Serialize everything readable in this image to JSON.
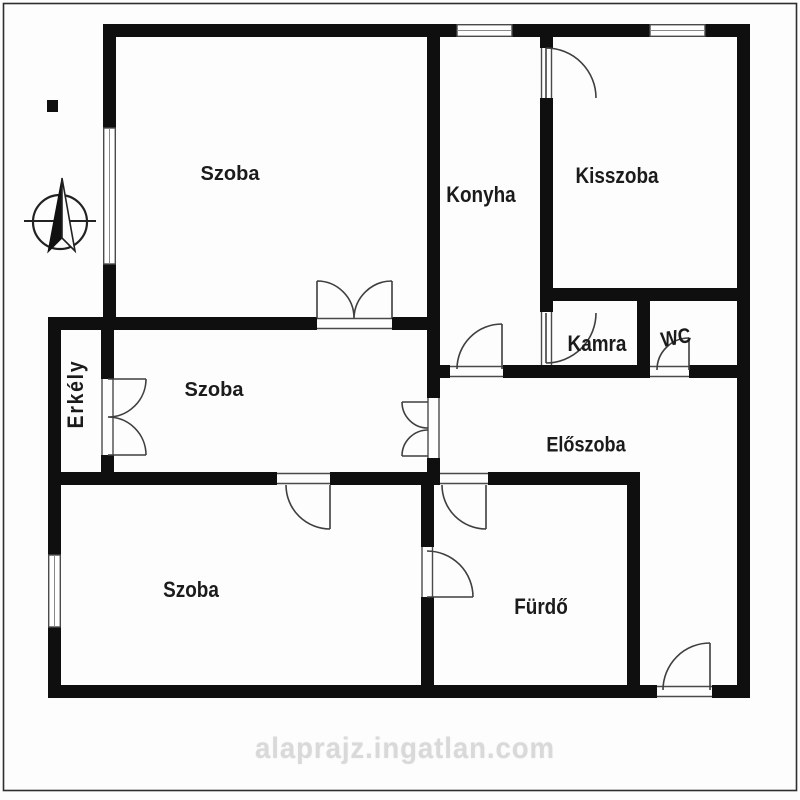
{
  "floorplan": {
    "rooms": [
      {
        "id": "szoba-top",
        "label": "Szoba"
      },
      {
        "id": "konyha",
        "label": "Konyha"
      },
      {
        "id": "kisszoba",
        "label": "Kisszoba"
      },
      {
        "id": "szoba-middle",
        "label": "Szoba"
      },
      {
        "id": "kamra",
        "label": "Kamra"
      },
      {
        "id": "wc",
        "label": "WC"
      },
      {
        "id": "eloszoba",
        "label": "Előszoba"
      },
      {
        "id": "erkely",
        "label": "Erkély"
      },
      {
        "id": "szoba-bottom",
        "label": "Szoba"
      },
      {
        "id": "furdo",
        "label": "Fürdő"
      }
    ],
    "icons": [
      {
        "name": "compass-rose-icon"
      },
      {
        "name": "north-needle-icon"
      }
    ],
    "watermark": "alaprajz.ingatlan.com",
    "colors": {
      "wall": "#0f0f0f",
      "door_line": "#3f3f3f",
      "frame": "#2e2e2e",
      "watermark": "#d9d9d9",
      "background": "#fdfdfd"
    }
  }
}
